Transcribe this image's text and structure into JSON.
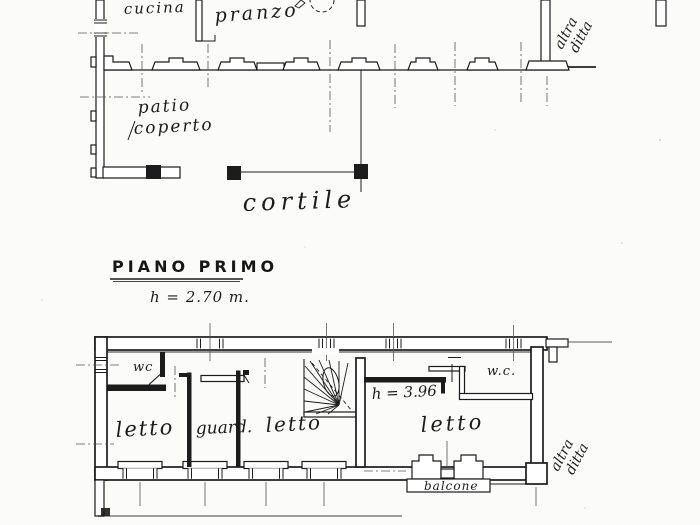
{
  "drawing_type": "scanned hand-drawn floor plan",
  "colors": {
    "ink": "#1c1c1c",
    "paper": "#fbfbf9"
  },
  "ground_floor": {
    "cucina": "cucina",
    "pranzo": "pranzo",
    "patio_line1": "patio",
    "patio_line2": "coperto",
    "cortile": "cortile",
    "neighbor_line1": "altra",
    "neighbor_line2": "ditta"
  },
  "first_floor": {
    "title": "PIANO PRIMO",
    "height_note": "h = 2.70 m.",
    "wc": "wc",
    "letto_left": "letto",
    "guard": "guard.",
    "letto_middle": "letto",
    "stair_height_note": "h = 3.96",
    "wc_right": "w.c.",
    "letto_right": "letto",
    "balcone": "balcone",
    "neighbor_line1": "altra",
    "neighbor_line2": "ditta"
  }
}
